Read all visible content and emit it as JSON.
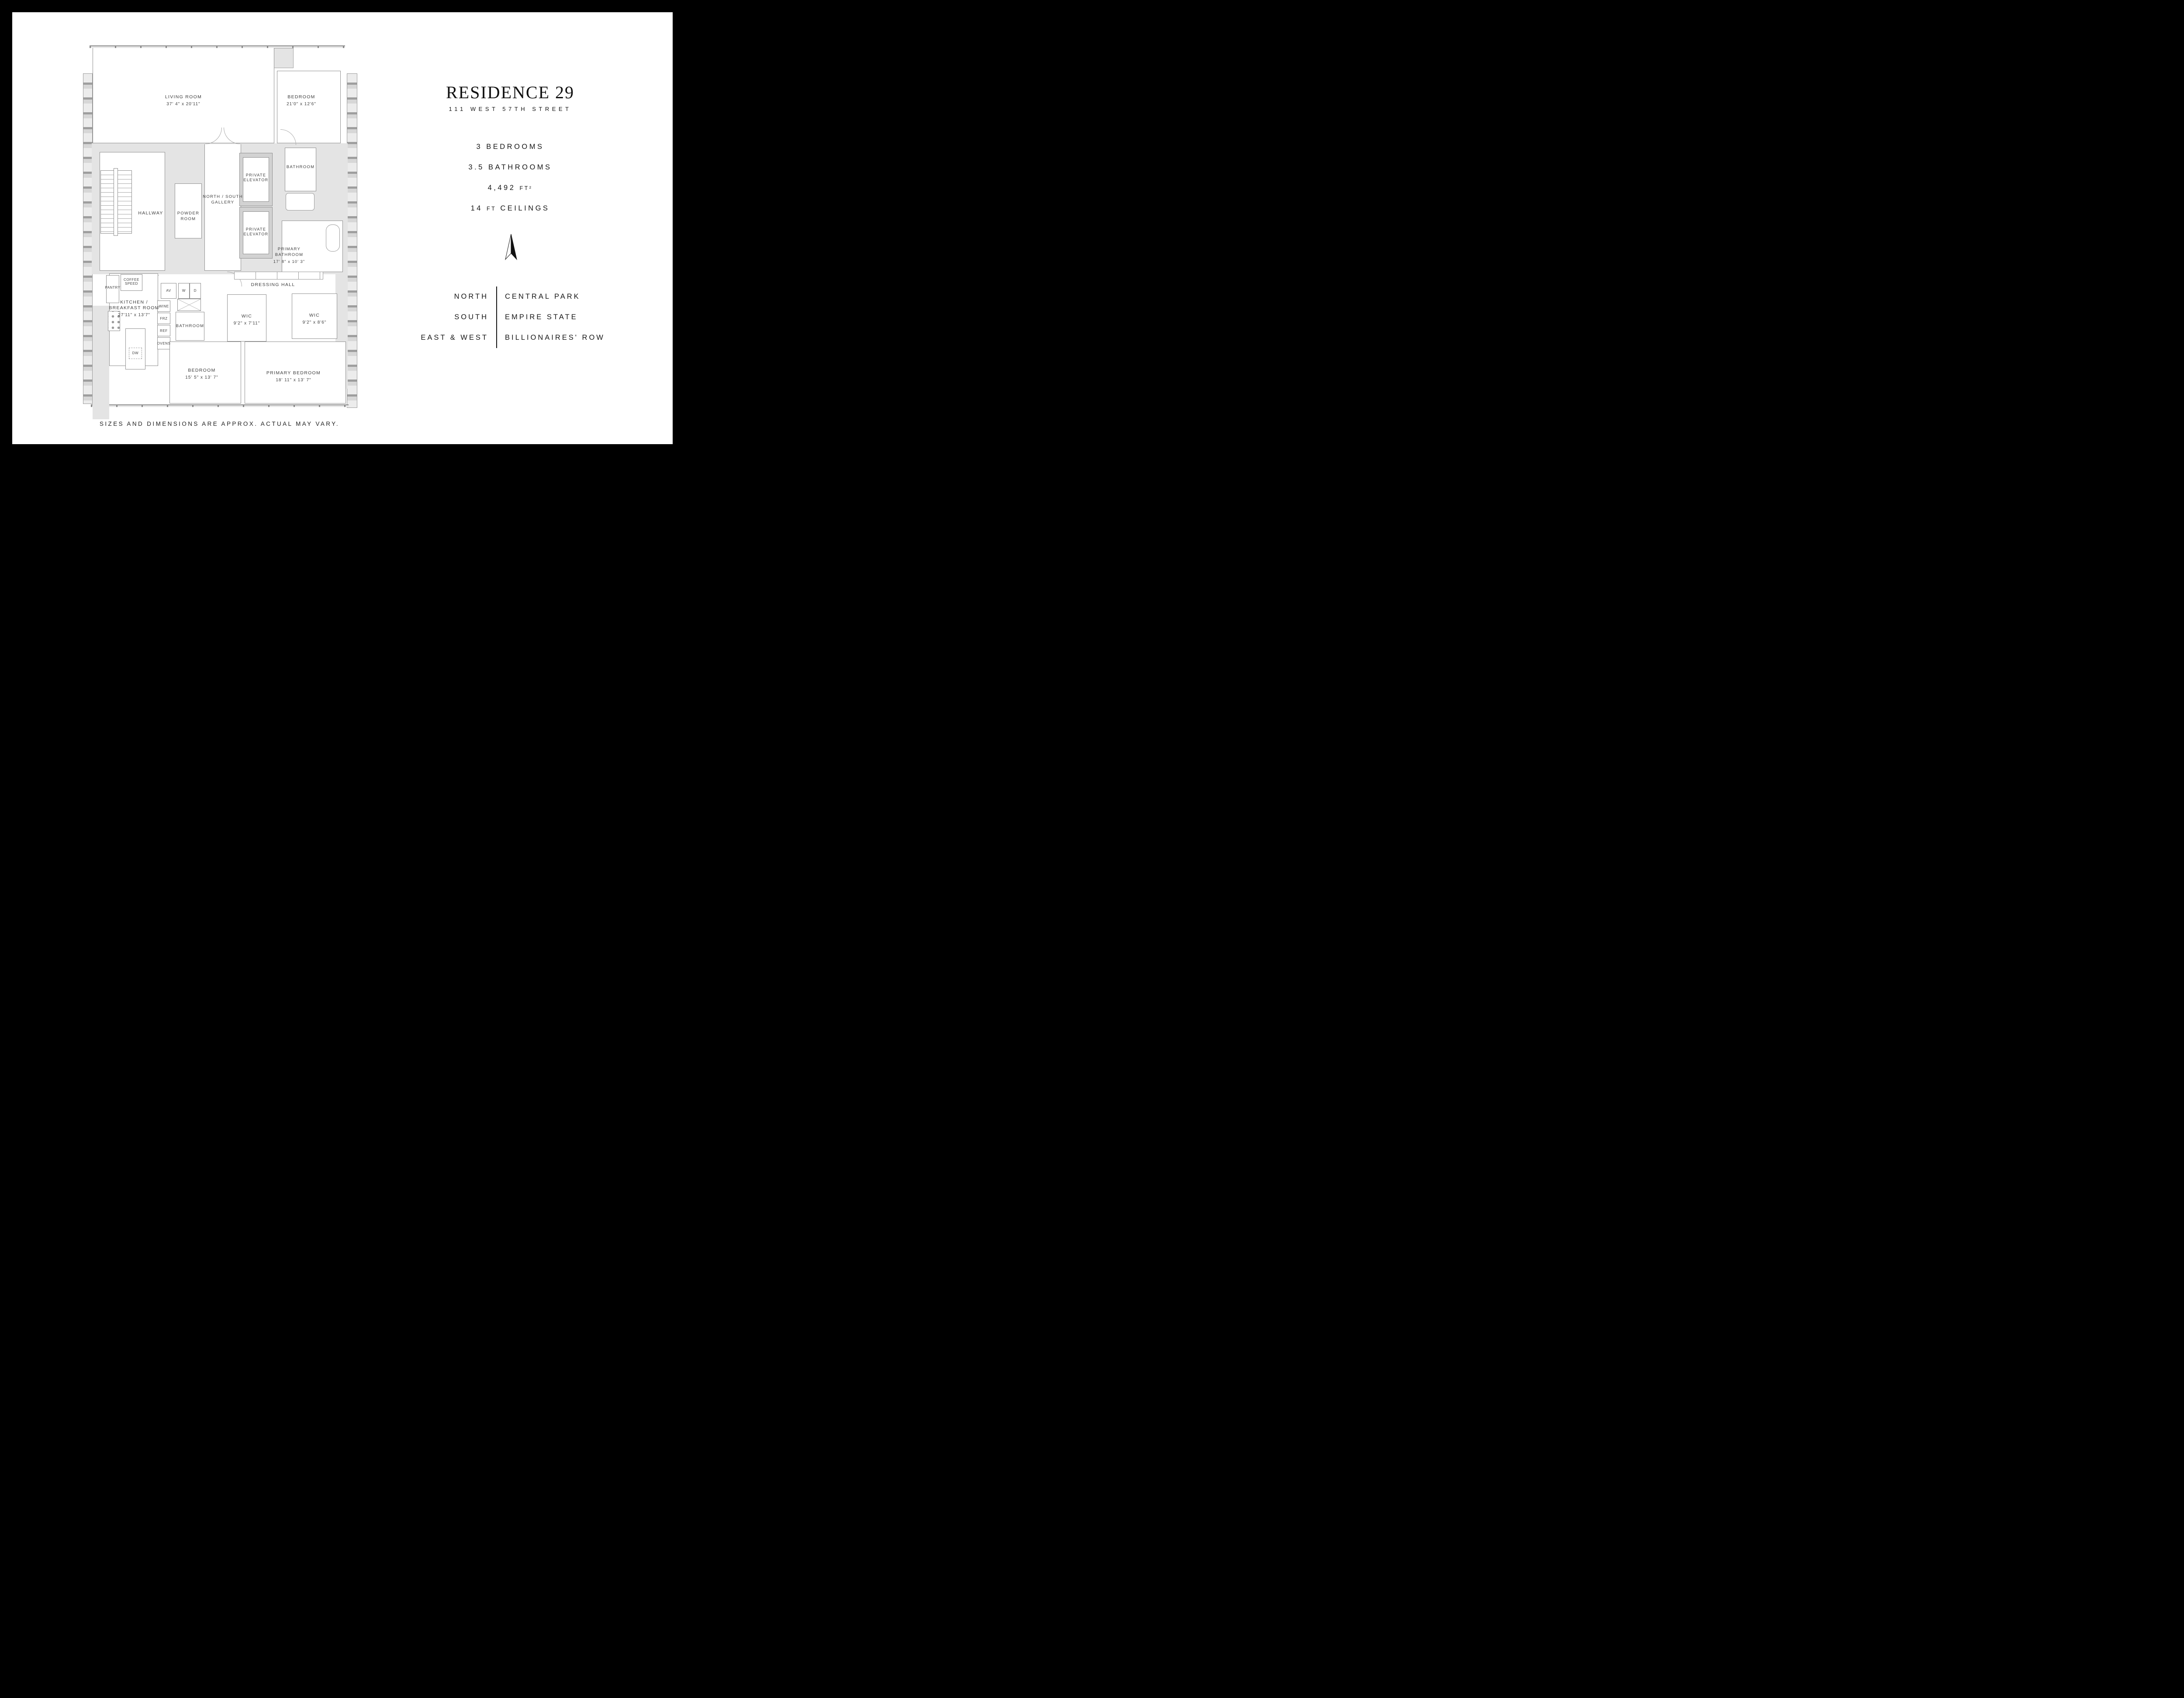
{
  "panel": {
    "title": "RESIDENCE 29",
    "subtitle": "111 WEST 57TH STREET",
    "stats": {
      "bedrooms": "3 BEDROOMS",
      "bathrooms": "3.5 BATHROOMS",
      "area_value": "4,492",
      "area_unit": "FT²",
      "ceilings_value": "14",
      "ceilings_unit": "FT",
      "ceilings_suffix": "CEILINGS"
    },
    "orientation": [
      {
        "direction": "NORTH",
        "view": "CENTRAL PARK"
      },
      {
        "direction": "SOUTH",
        "view": "EMPIRE STATE"
      },
      {
        "direction": "EAST & WEST",
        "view": "BILLIONAIRES' ROW"
      }
    ]
  },
  "plan": {
    "living_room": {
      "name": "LIVING ROOM",
      "dims": "37' 4\" x 20'11\""
    },
    "bedroom_top": {
      "name": "BEDROOM",
      "dims": "21'0\" x 12'6\""
    },
    "bathroom_top": {
      "name": "BATHROOM"
    },
    "private_elevator": {
      "name": "PRIVATE ELEVATOR"
    },
    "gallery": {
      "name": "NORTH / SOUTH GALLERY"
    },
    "hallway": {
      "name": "HALLWAY"
    },
    "powder_room": {
      "name": "POWDER ROOM"
    },
    "primary_bathroom": {
      "name": "PRIMARY BATHROOM",
      "dims": "17' 8\" x 10' 3\""
    },
    "dressing_hall": {
      "name": "DRESSING HALL"
    },
    "pantry": {
      "name": "PANTRY"
    },
    "coffee": {
      "name": "COFFEE SPEED"
    },
    "kitchen": {
      "name": "KITCHEN / BREAKFAST ROOM",
      "dims": "27'11\" x 13'7\""
    },
    "appliances": {
      "av": "AV",
      "washer": "W",
      "dryer": "D",
      "wine": "WINE",
      "freezer": "FRZ",
      "refrigerator": "REF",
      "ovens": "OVENS",
      "dishwasher": "DW"
    },
    "bathroom_lower": {
      "name": "BATHROOM"
    },
    "wic_1": {
      "name": "WIC",
      "dims": "9'2\" x 7'11\""
    },
    "wic_2": {
      "name": "WIC",
      "dims": "9'2\" x 8'6\""
    },
    "bedroom_lower": {
      "name": "BEDROOM",
      "dims": "15' 5\" x 13' 7\""
    },
    "primary_bedroom": {
      "name": "PRIMARY BEDROOM",
      "dims": "18' 11\" x 13' 7\""
    }
  },
  "footer": {
    "note": "SIZES AND DIMENSIONS ARE APPROX. ACTUAL MAY VARY."
  },
  "colors": {
    "frame": "#000000",
    "sheet": "#ffffff",
    "poche": "#e4e4e4",
    "wall_line": "#8f8f8f",
    "text": "#161616"
  }
}
